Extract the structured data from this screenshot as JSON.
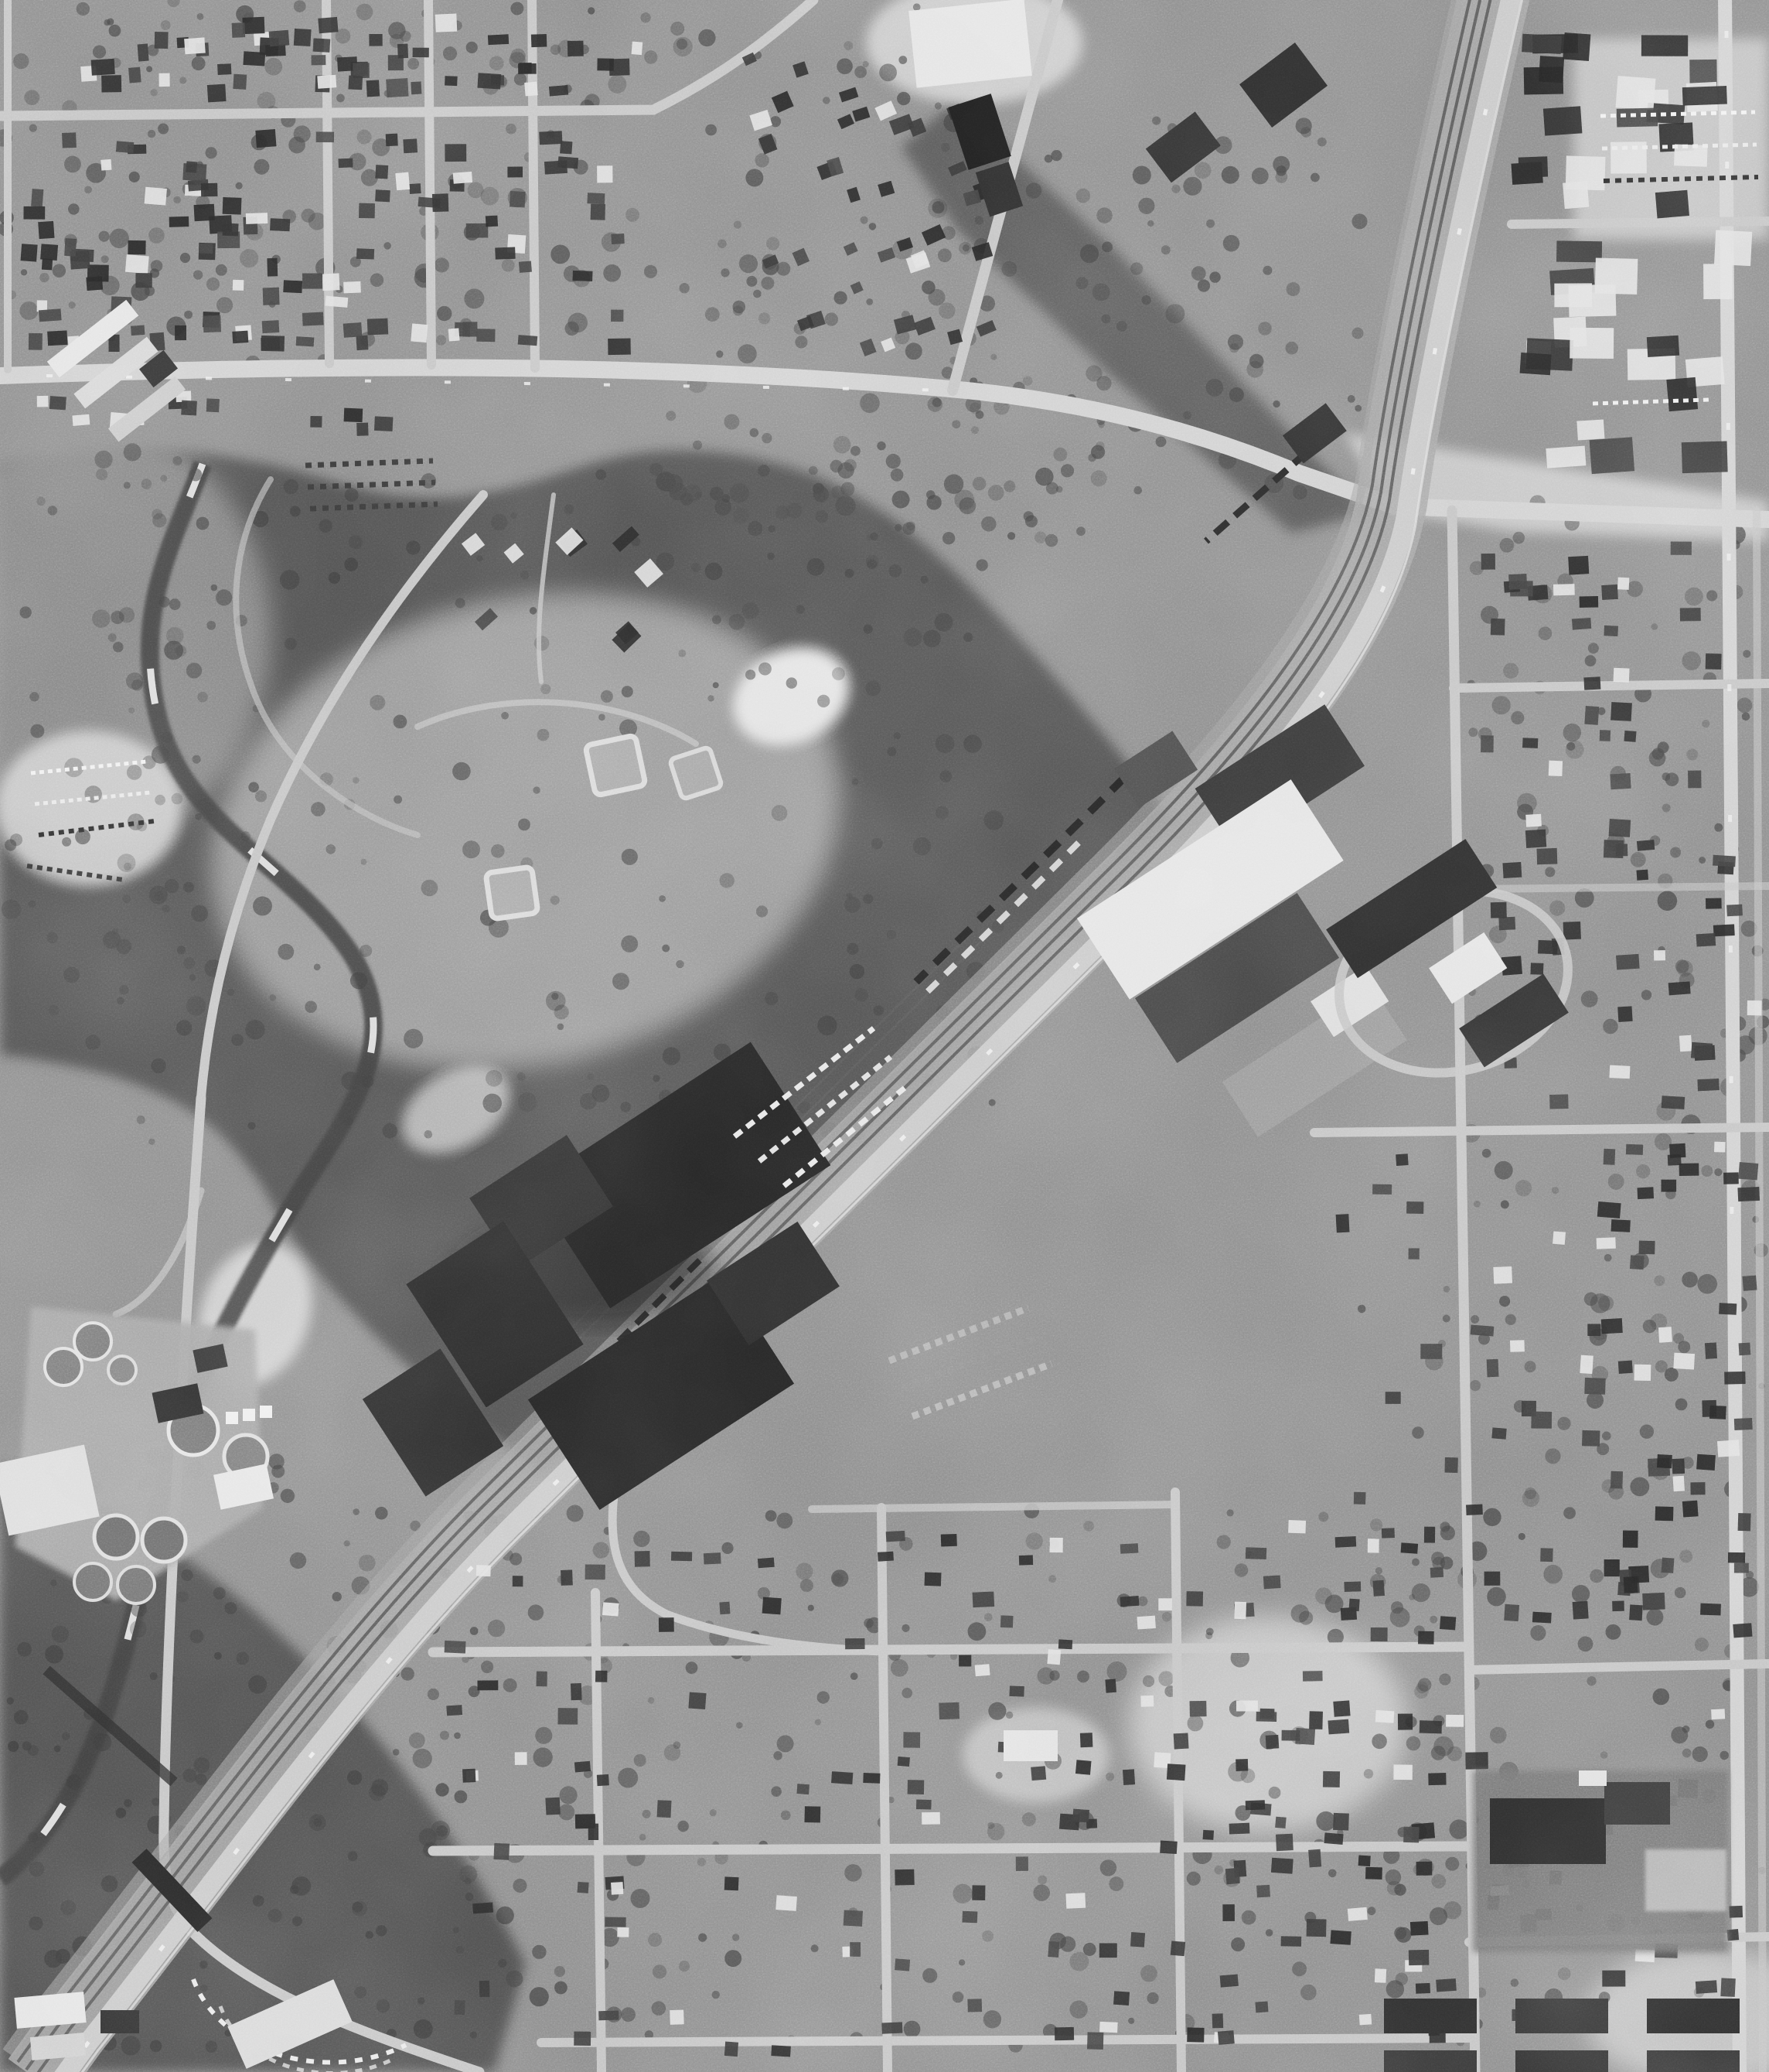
{
  "meta": {
    "title": "Aerial photograph",
    "description": "Black-and-white vertical aerial photograph of a small city: a multi-track railroad and parallel highway corridor runs diagonally from upper right to lower left; a dark wooded city park with a creek, three baseball diamonds and a round clearing lies left of center; a dark sawtooth-roof factory complex and white-roofed warehouses flank the corridor; a water treatment plant with circular tanks sits at lower left; street grids of houses fill the northwest, east and south; a brighter downtown business district occupies the upper right."
  },
  "palette": {
    "ground": "#8d8d8d",
    "ground_light": "#9a9a9a",
    "woods": "#525252",
    "floodplain": "#4c4c4c",
    "meadow": "#999999",
    "street": "#c4c4c4",
    "main_street": "#d0d0d0",
    "rail": "#5e5e5e",
    "rail_bed": "#a7a7a7",
    "highway": "#c9c9c9",
    "building_dark": "#2a2a2a",
    "building_light": "#e4e4e4",
    "bright_patch": "#d8d8d8",
    "creek": "#3c3c3c",
    "water_glint": "#ebebeb",
    "tree": "#434343",
    "shadow": "#1d1d1d"
  },
  "landmarks": [
    {
      "id": "rail-corridor",
      "label": "railroad and highway corridor"
    },
    {
      "id": "grade-crossing",
      "label": "street grade crossing of railroad"
    },
    {
      "id": "city-park",
      "label": "wooded park with creek and ball fields"
    },
    {
      "id": "baseball-diamonds",
      "label": "three baseball diamonds"
    },
    {
      "id": "factory-complex",
      "label": "dark sawtooth-roof factory"
    },
    {
      "id": "warehouses",
      "label": "white-roofed warehouses"
    },
    {
      "id": "freight-cars",
      "label": "freight cars on sidings"
    },
    {
      "id": "water-treatment-plant",
      "label": "treatment plant with circular tanks"
    },
    {
      "id": "road-overpass",
      "label": "road overpass at rail crossing"
    },
    {
      "id": "downtown-blocks",
      "label": "downtown commercial blocks"
    },
    {
      "id": "residential-northwest",
      "label": "northwest residential grid"
    },
    {
      "id": "residential-east",
      "label": "east residential grid"
    },
    {
      "id": "residential-south",
      "label": "south residential grid"
    },
    {
      "id": "school-campus",
      "label": "school with dark play yard"
    },
    {
      "id": "drive-in-arc",
      "label": "arc-shaped parking rows"
    },
    {
      "id": "creek",
      "label": "meandering creek"
    }
  ]
}
